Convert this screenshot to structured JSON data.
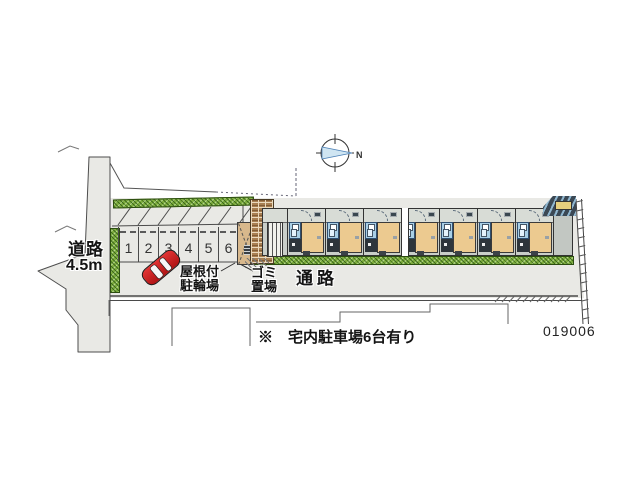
{
  "plan": {
    "note": "※　宅内駐車場6台有り",
    "number": "019006"
  },
  "road": {
    "name_label": "道路",
    "width_label": "4.5m"
  },
  "passage": {
    "label": "通路"
  },
  "bike_parking": {
    "line1": "屋根付",
    "line2": "駐輪場"
  },
  "garbage": {
    "line1": "ゴミ",
    "line2": "置場"
  },
  "compass": {
    "north": "N"
  },
  "parking": {
    "space_numbers": [
      "1",
      "2",
      "3",
      "4",
      "5",
      "6"
    ]
  },
  "building": {
    "unit_count": 7
  },
  "colors": {
    "site": "#e9e9e5",
    "hedge": "#7fae3f",
    "room": "#ecca90",
    "bath": "#a9cfe6",
    "brick": "#a87f52",
    "car": "#cf1d1d",
    "compass_arrow": "#cfe5f2"
  }
}
